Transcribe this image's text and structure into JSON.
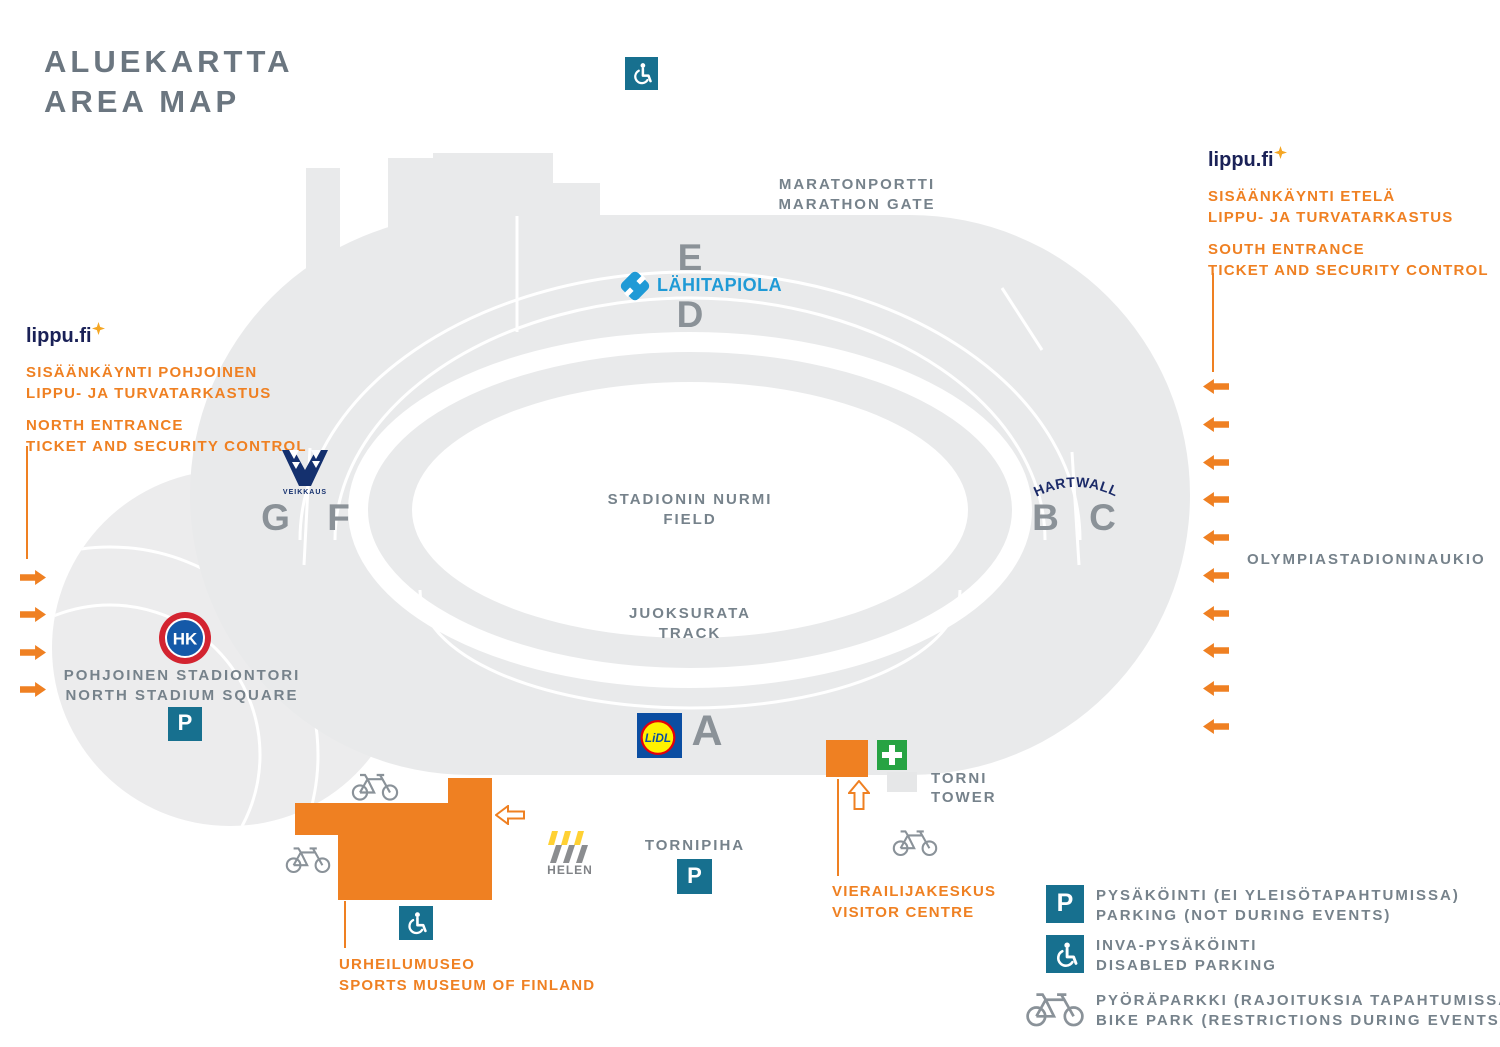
{
  "title": {
    "fi": "ALUEKARTTA",
    "en": "AREA MAP"
  },
  "entrances": {
    "north": {
      "brand": "lippu.fi",
      "fi_line1": "SISÄÄNKÄYNTI POHJOINEN",
      "fi_line2": "LIPPU- JA TURVATARKASTUS",
      "en_line1": "NORTH ENTRANCE",
      "en_line2": "TICKET AND SECURITY CONTROL"
    },
    "south": {
      "brand": "lippu.fi",
      "fi_line1": "SISÄÄNKÄYNTI ETELÄ",
      "fi_line2": "LIPPU- JA TURVATARKASTUS",
      "en_line1": "SOUTH ENTRANCE",
      "en_line2": "TICKET AND SECURITY CONTROL"
    }
  },
  "labels": {
    "marathon_gate_fi": "MARATONPORTTI",
    "marathon_gate_en": "MARATHON GATE",
    "field_fi": "STADIONIN NURMI",
    "field_en": "FIELD",
    "track_fi": "JUOKSURATA",
    "track_en": "TRACK",
    "north_square_fi": "POHJOINEN STADIONTORI",
    "north_square_en": "NORTH STADIUM SQUARE",
    "tornipiha": "TORNIPIHA",
    "tower_fi": "TORNI",
    "tower_en": "TOWER",
    "visitor_fi": "VIERAILIJAKESKUS",
    "visitor_en": "VISITOR CENTRE",
    "museum_fi": "URHEILUMUSEO",
    "museum_en": "SPORTS MUSEUM OF FINLAND",
    "east_square": "OLYMPIASTADIONINAUKIO"
  },
  "sections": {
    "a": "A",
    "b": "B",
    "c": "C",
    "d": "D",
    "e": "E",
    "f": "F",
    "g": "G"
  },
  "sponsors": {
    "lahitapiola": "LÄHITAPIOLA",
    "veikkaus": "VEIKKAUS",
    "hartwall": "HARTWALL",
    "hk": "HK",
    "lidl": "LiDL",
    "helen": "HELEN"
  },
  "legend": [
    {
      "fi": "PYSÄKÖINTI (EI YLEISÖTAPAHTUMISSA)",
      "en": "PARKING (NOT DURING EVENTS)"
    },
    {
      "fi": "INVA-PYSÄKÖINTI",
      "en": "DISABLED PARKING"
    },
    {
      "fi": "PYÖRÄPARKKI (RAJOITUKSIA TAPAHTUMISSA)",
      "en": "BIKE PARK (RESTRICTIONS DURING EVENTS)"
    }
  ],
  "symbols": {
    "parking": "P"
  },
  "colors": {
    "orange": "#EF8022",
    "teal": "#17708F",
    "label_gray": "#76828B",
    "stadium_gray": "#E9EAEB",
    "navy": "#1A2157",
    "lahitapiola_blue": "#1F9AD6",
    "veikkaus_navy": "#14306E",
    "hartwall_navy": "#1B2A68",
    "green": "#27A343",
    "hk_red": "#D32430",
    "hk_blue": "#1559A8",
    "lidl_blue": "#0B4EA2",
    "lidl_yellow": "#FFF200",
    "lidl_red": "#E3000B",
    "helen_yellow": "#FFD133"
  }
}
